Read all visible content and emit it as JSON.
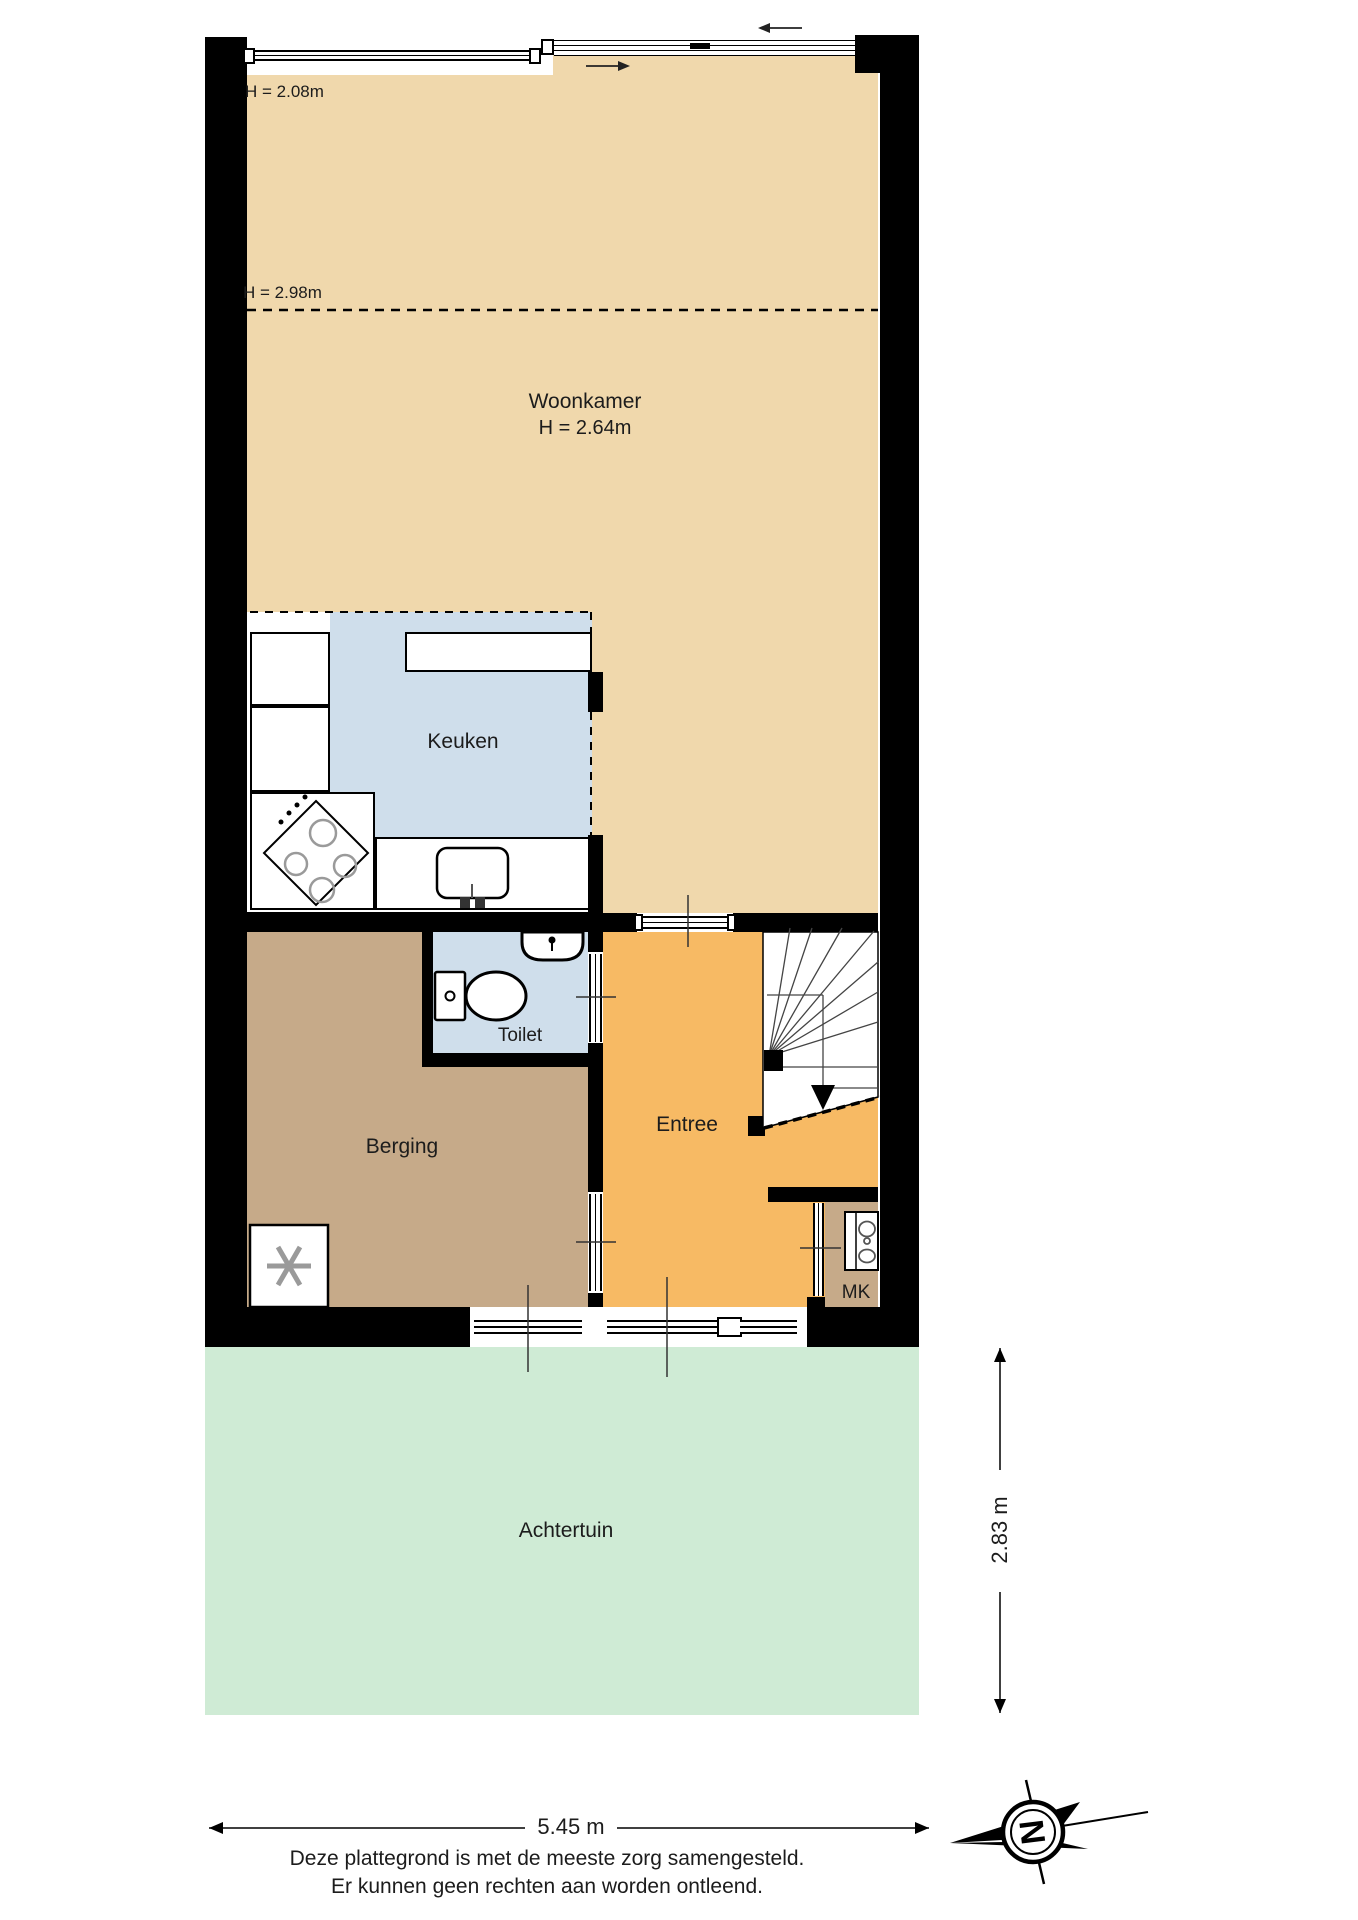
{
  "rooms": {
    "woonkamer": {
      "label": "Woonkamer",
      "height_label": "H = 2.64m",
      "color": "#f0d8ac"
    },
    "keuken": {
      "label": "Keuken",
      "color": "#cfdeeb"
    },
    "toilet": {
      "label": "Toilet",
      "color": "#cfdeeb"
    },
    "berging": {
      "label": "Berging",
      "color": "#c6aa89"
    },
    "entree": {
      "label": "Entree",
      "color": "#f7ba64"
    },
    "mk": {
      "label": "MK",
      "color": "#c6aa89"
    },
    "achtertuin": {
      "label": "Achtertuin",
      "color": "#cfebd5"
    }
  },
  "annotations": {
    "ceiling_low": "H = 2.08m",
    "ceiling_high": "H = 2.98m"
  },
  "dimensions": {
    "total_width": "5.45 m",
    "garden_depth": "2.83 m"
  },
  "compass": {
    "letter": "N"
  },
  "footer": {
    "line1": "Deze plattegrond is met de meeste zorg samengesteld.",
    "line2": "Er kunnen geen rechten aan worden ontleend."
  },
  "colors": {
    "wall": "#000000",
    "stair_area": "#ffffff"
  }
}
